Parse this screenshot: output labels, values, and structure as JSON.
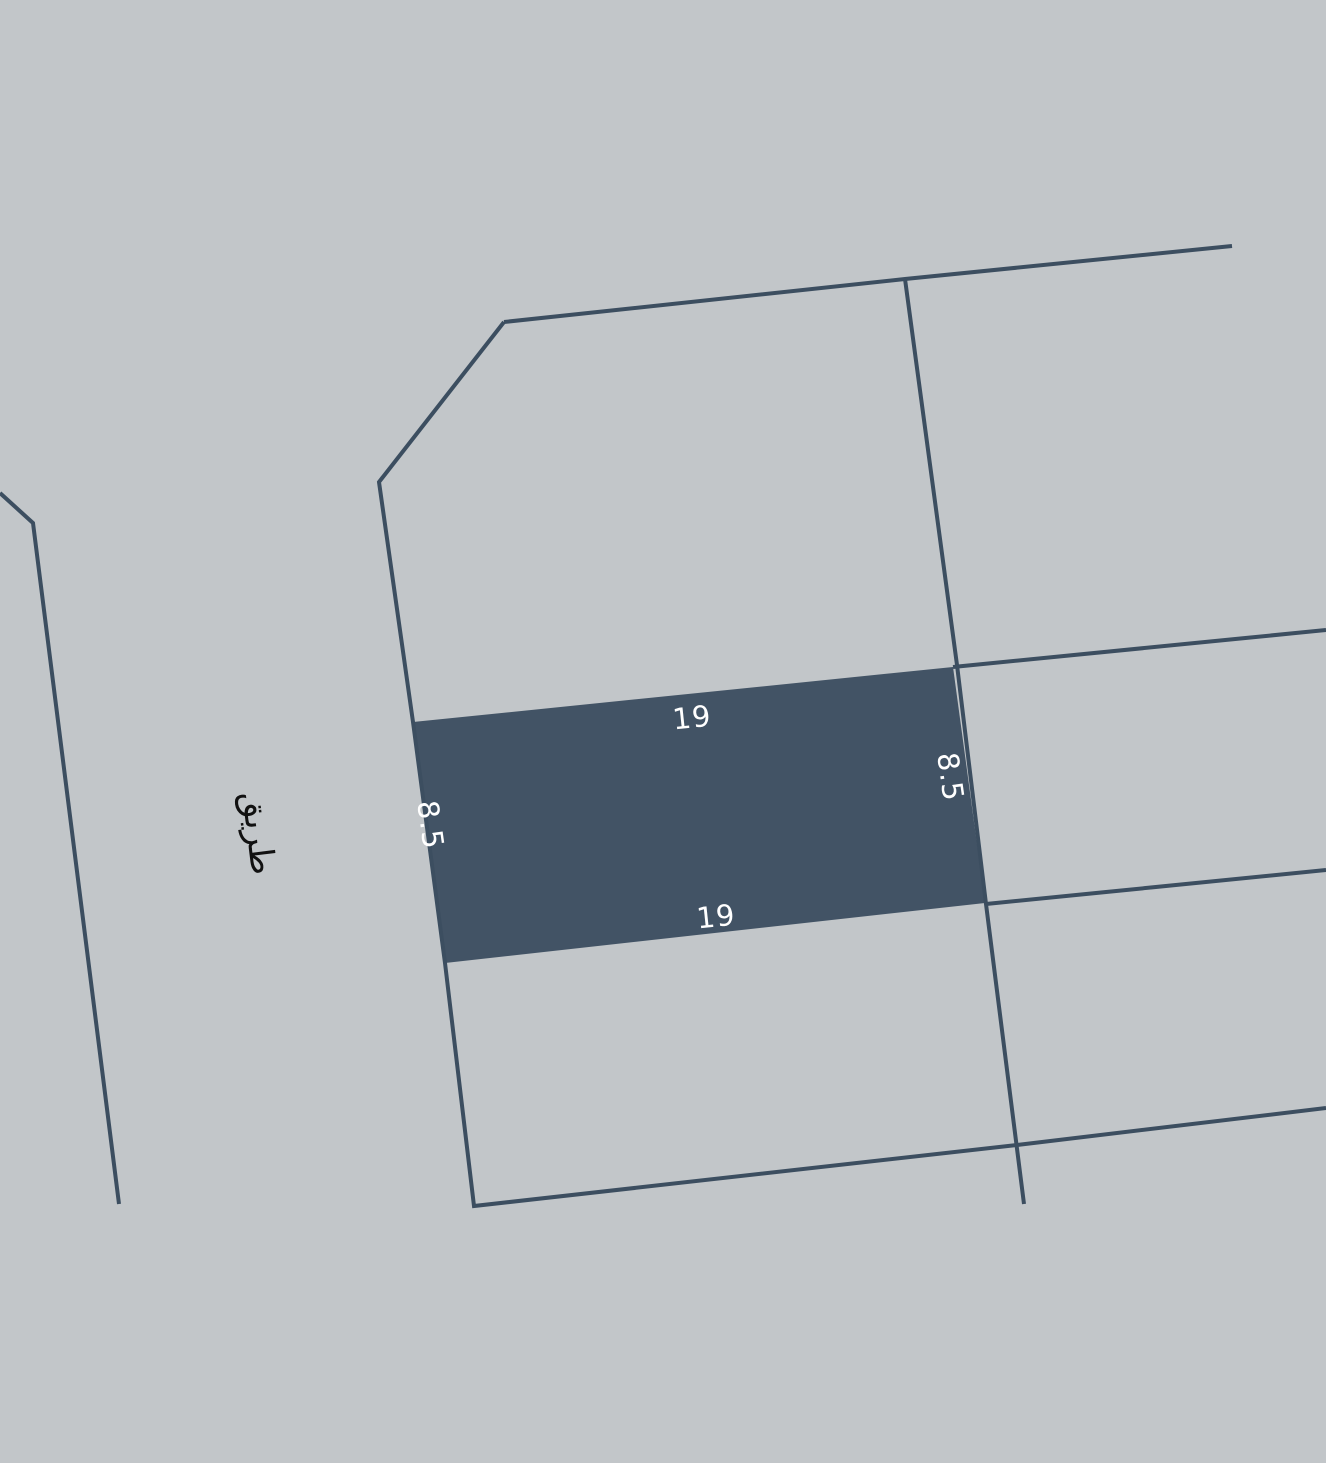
{
  "map": {
    "background_color": "#c2c6c9",
    "boundary_color": "#3c4e60",
    "road_label": "طريق",
    "selected_parcel": {
      "fill_color": "#425365",
      "dim_top": "19",
      "dim_bottom": "19",
      "dim_left": "8.5",
      "dim_right": "8.5"
    }
  }
}
